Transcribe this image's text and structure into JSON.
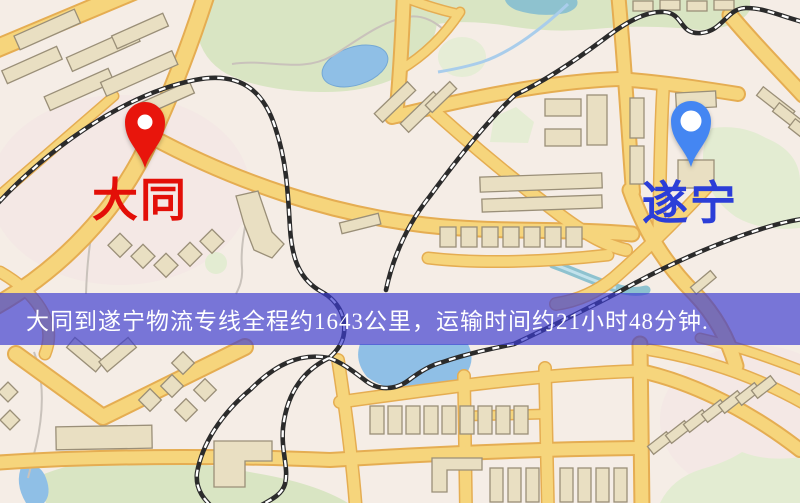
{
  "banner": {
    "text": "大同到遂宁物流专线全程约1643公里，运输时间约21小时48分钟."
  },
  "markers": [
    {
      "id": "origin",
      "label": "大同",
      "color": "#e8150c"
    },
    {
      "id": "destination",
      "label": "遂宁",
      "color": "#4486f2"
    }
  ],
  "colors": {
    "background": "#f5ede6",
    "road_fill": "#f6d57c",
    "road_casing": "#e5ad52",
    "park": "#d9e5c3",
    "park_light": "#e3ecd2",
    "water": "#8fbfe6",
    "water_teal": "#8ec2cf",
    "railway": "#2b2b2b",
    "building_fill": "#e9dfc2",
    "building_stroke": "#9a8f78",
    "path_gray": "#c9c2bb",
    "banner_bg": "rgba(60,60,208,0.68)",
    "banner_text": "#ffffff",
    "label_red": "#e30f08",
    "label_blue": "#2b3ed8"
  }
}
